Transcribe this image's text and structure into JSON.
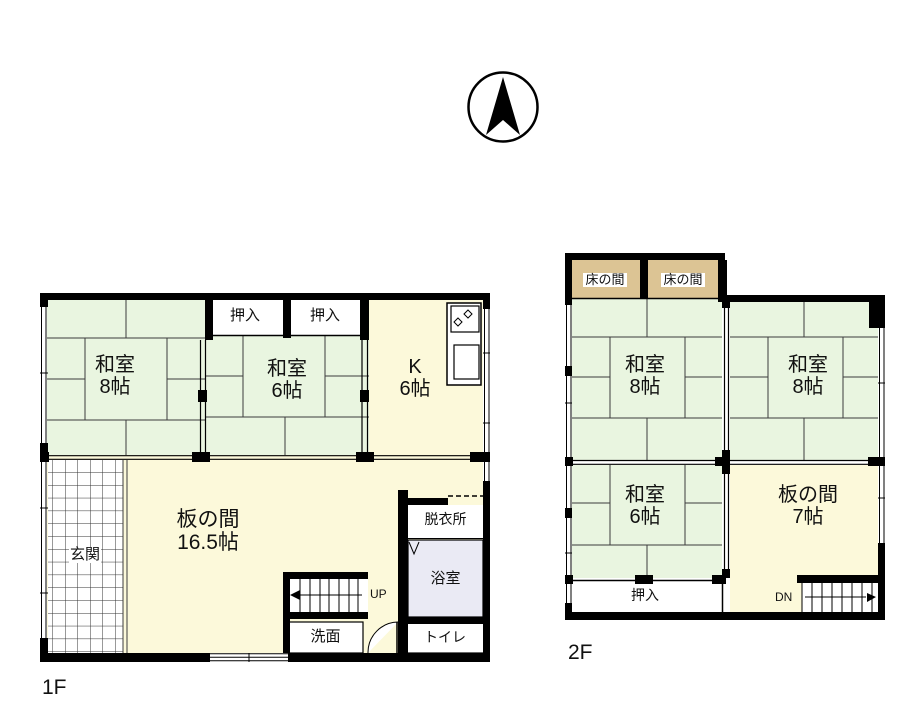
{
  "compass": {
    "name": "north-arrow"
  },
  "colors": {
    "tatami": "#e9f5e0",
    "wood_floor": "#fcf9da",
    "tokonoma": "#dcc494",
    "bath": "#eaeaf4",
    "wall": "#000000",
    "white": "#ffffff"
  },
  "floor1": {
    "label": "1F",
    "washitsu8": {
      "name": "和室",
      "size": "8帖"
    },
    "oshiire_left": "押入",
    "oshiire_right": "押入",
    "washitsu6": {
      "name": "和室",
      "size": "6帖"
    },
    "kitchen": {
      "name": "K",
      "size": "6帖"
    },
    "genkan": "玄関",
    "itanoma": {
      "name": "板の間",
      "size": "16.5帖"
    },
    "datsuijo": "脱衣所",
    "yokushitsu": "浴室",
    "senmen": "洗面",
    "toire": "トイレ",
    "stairs": "UP"
  },
  "floor2": {
    "label": "2F",
    "tokonoma_left": "床の間",
    "tokonoma_right": "床の間",
    "washitsu8_left": {
      "name": "和室",
      "size": "8帖"
    },
    "washitsu8_right": {
      "name": "和室",
      "size": "8帖"
    },
    "washitsu6": {
      "name": "和室",
      "size": "6帖"
    },
    "itanoma": {
      "name": "板の間",
      "size": "7帖"
    },
    "oshiire": "押入",
    "stairs": "DN"
  }
}
